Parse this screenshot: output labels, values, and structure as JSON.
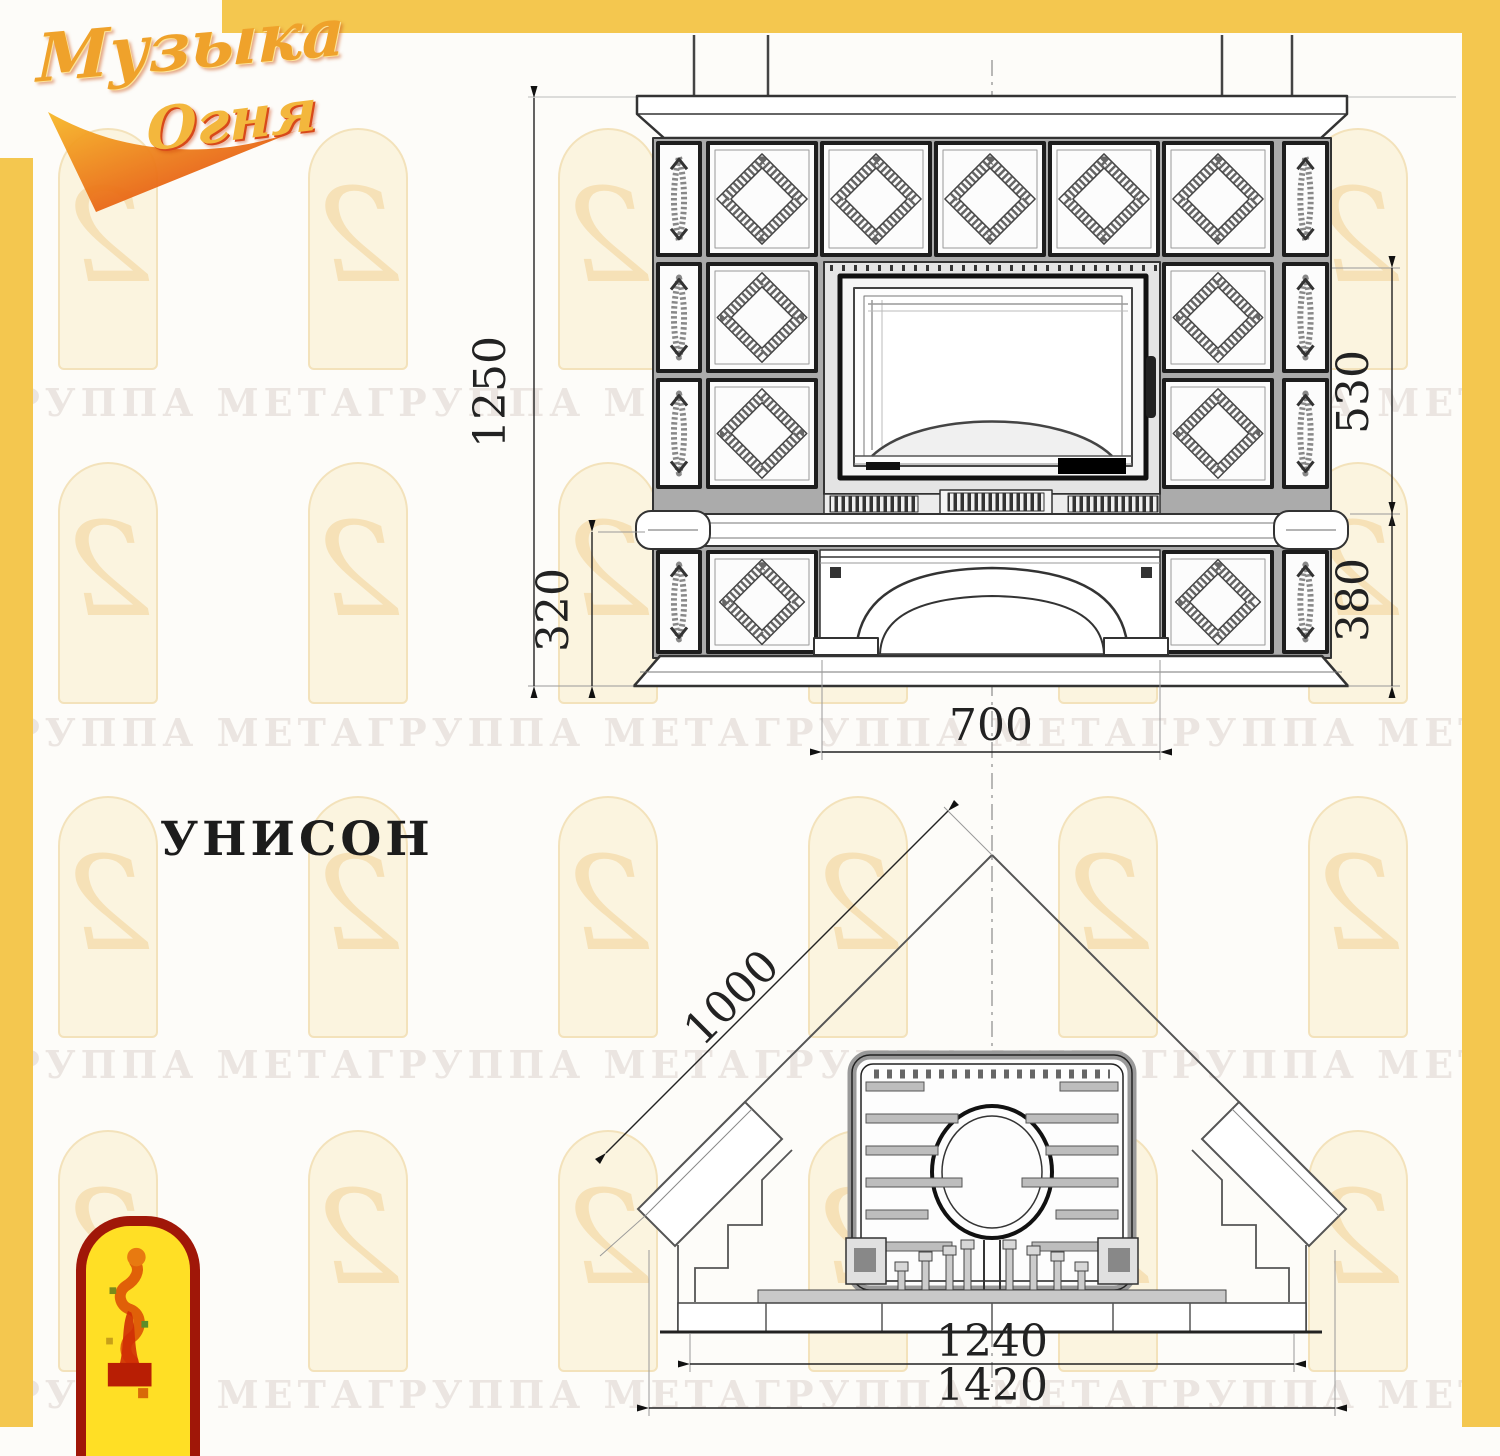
{
  "page": {
    "title_label": "УНИСОН"
  },
  "logo": {
    "word1": "Музыка",
    "word2": "Огня"
  },
  "watermark": {
    "row_text": "ГРУППА МЕТАГРУППА МЕТАГРУППА МЕТАГРУППА МЕТАГРУППА МЕТА"
  },
  "front_view": {
    "dims": {
      "overall_height": "1250",
      "firebox_zone_height": "530",
      "base_zone_height_left": "320",
      "base_zone_height_right": "380",
      "portal_width": "700"
    }
  },
  "plan_view": {
    "dims": {
      "wall_length": "1000",
      "inner_width": "1240",
      "overall_width": "1420"
    }
  },
  "colors": {
    "frame_yellow": "#f4c74f",
    "line_dark": "#2e2e2e",
    "logo_gold": "#efa22b",
    "logo_red": "#d8491a",
    "emblem_yellow": "#ffdf25",
    "emblem_border": "#a01708"
  }
}
